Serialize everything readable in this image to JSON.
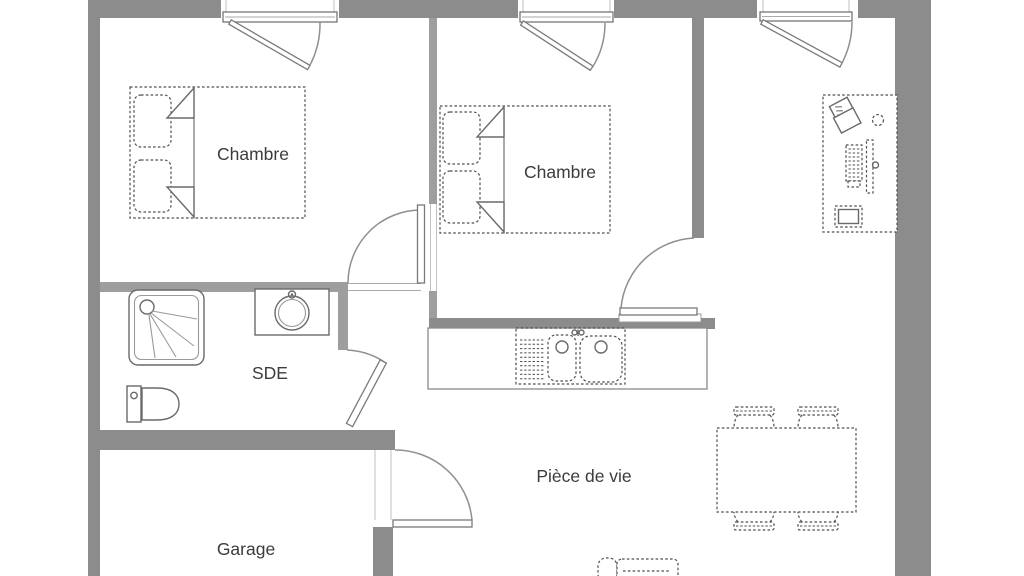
{
  "plan": {
    "title": "floor-plan",
    "rooms": {
      "bedroom1": {
        "label": "Chambre"
      },
      "bedroom2": {
        "label": "Chambre"
      },
      "shower_room": {
        "label": "SDE"
      },
      "garage": {
        "label": "Garage"
      },
      "living_room": {
        "label": "Pièce de vie"
      }
    }
  },
  "colors": {
    "wall": "#8c8c8c",
    "wall_light": "#9e9e9e",
    "line": "#4f4f4f",
    "ink": "#3c3c3c"
  }
}
